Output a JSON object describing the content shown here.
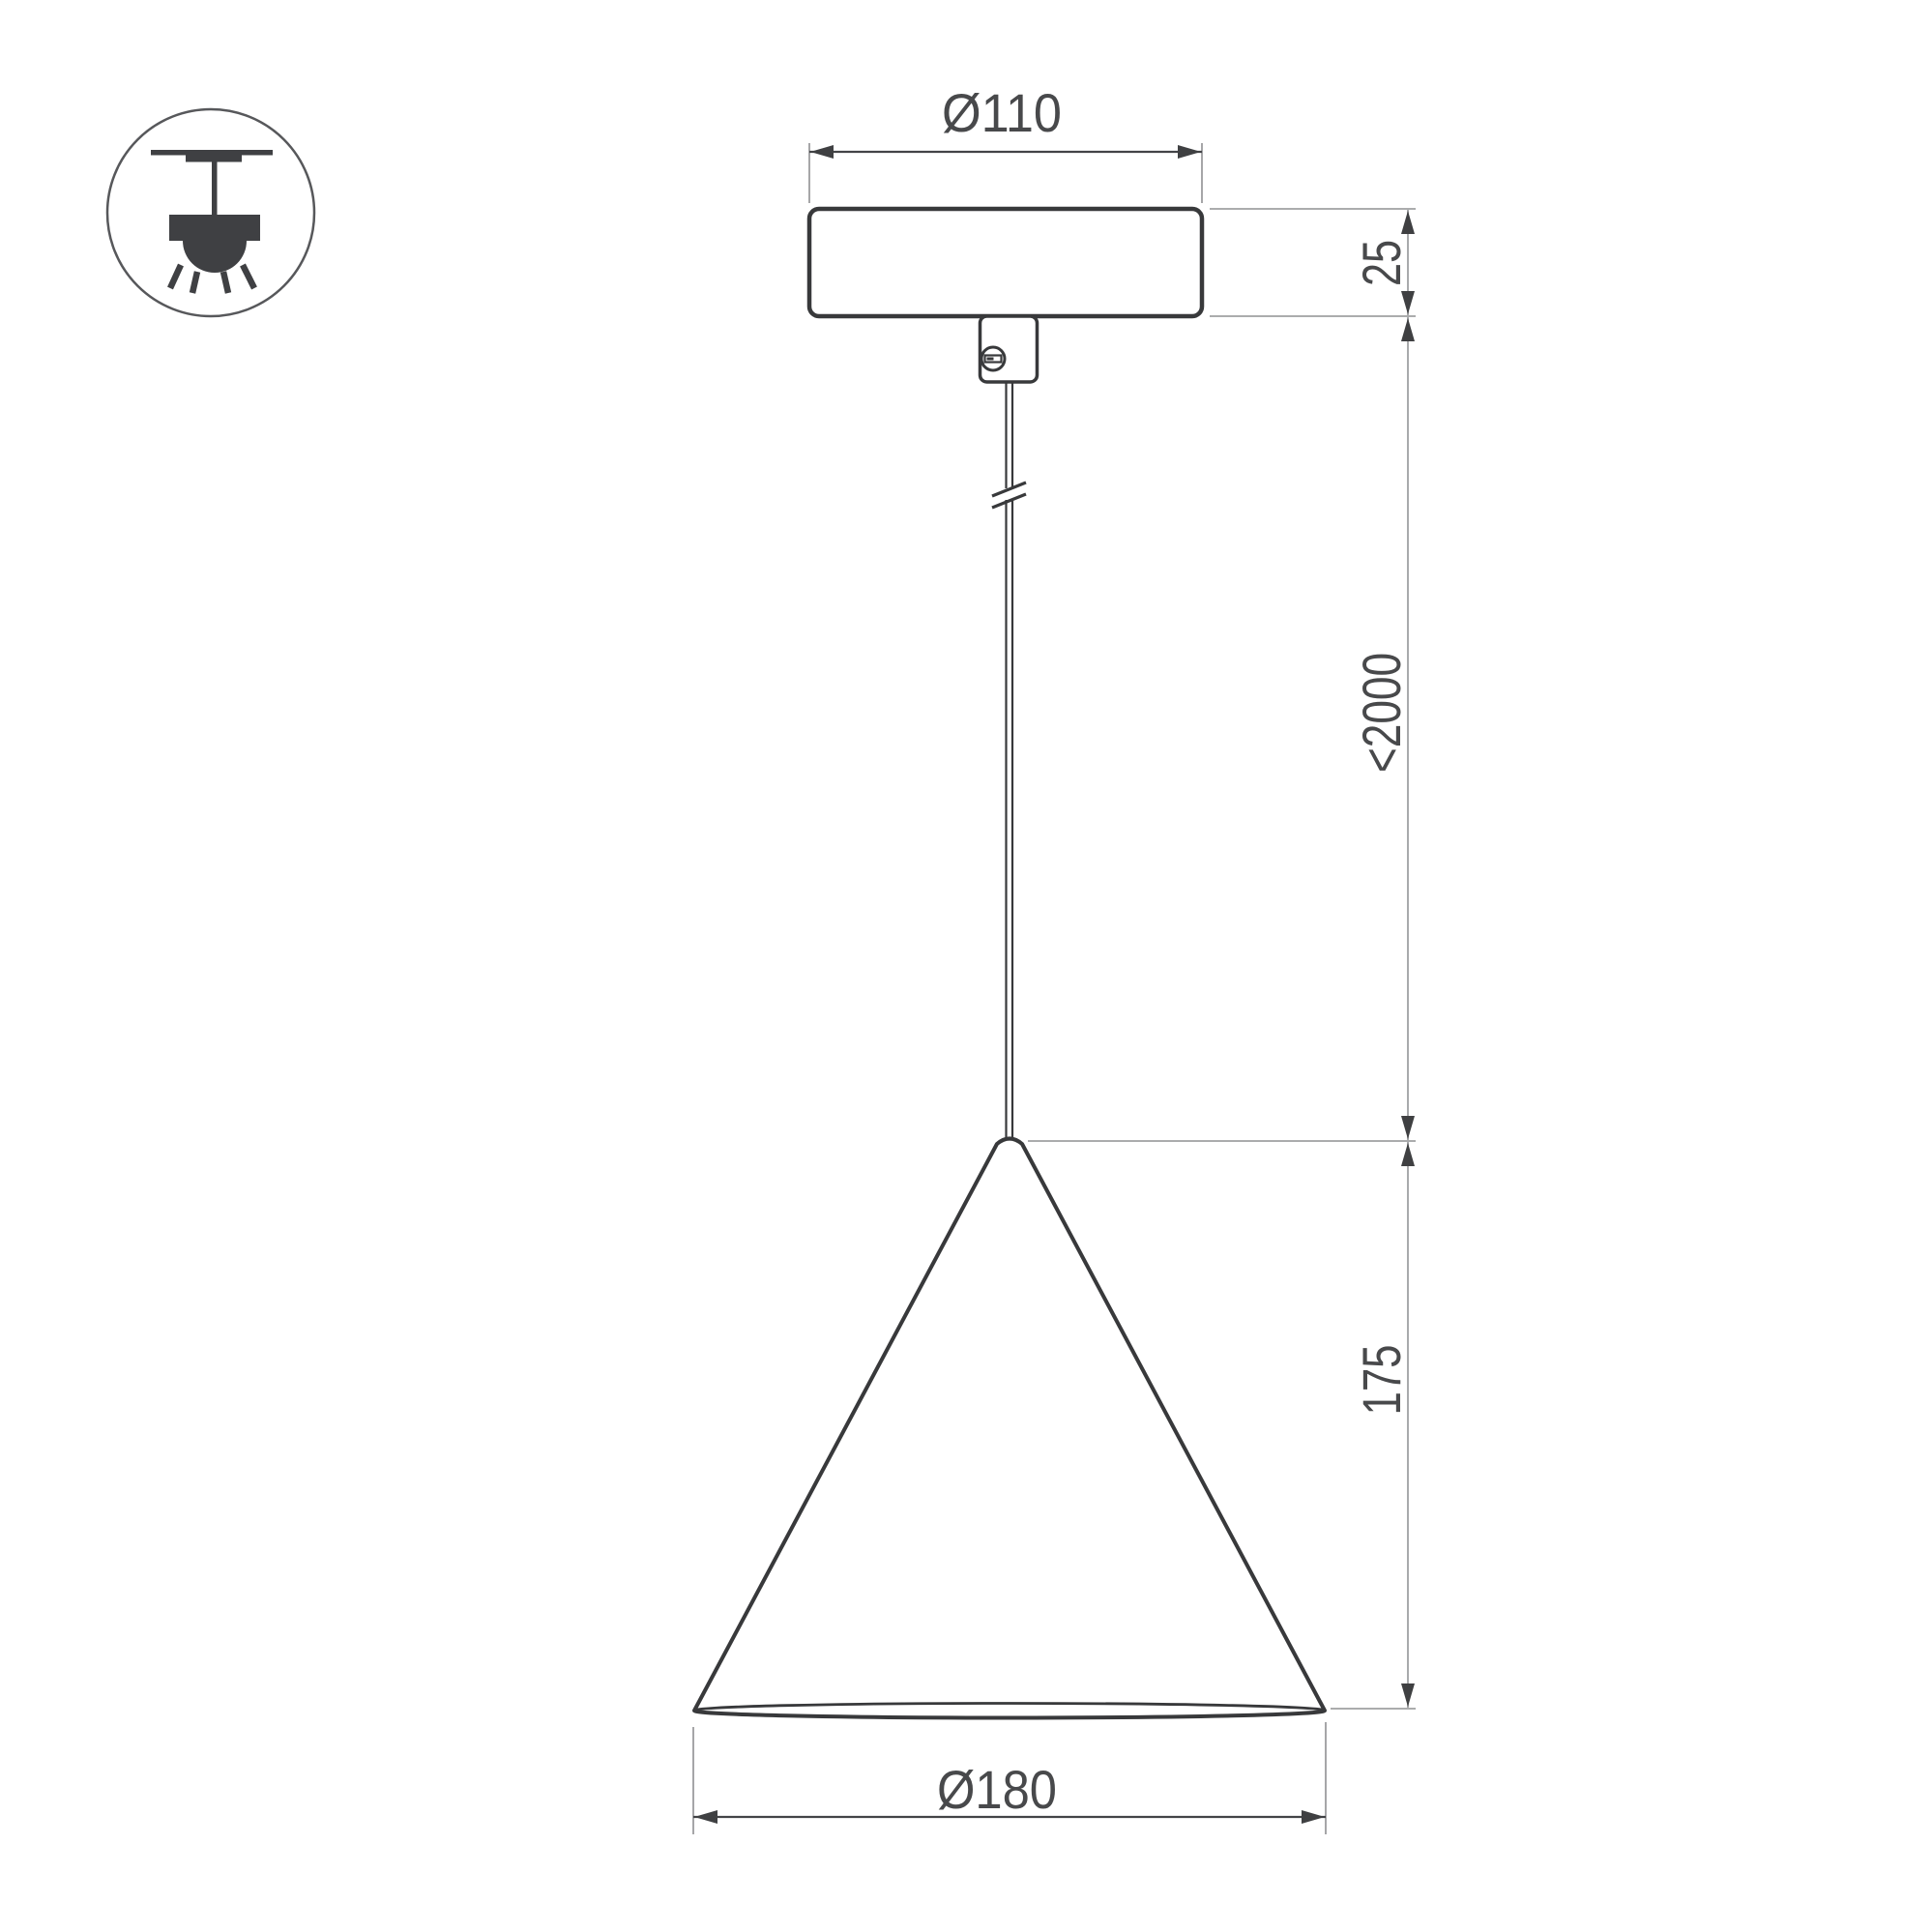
{
  "drawing": {
    "kind": "pendant-lamp-dimension-drawing",
    "icon": "ceiling-pendant-light-icon",
    "dimensions": {
      "canopy_diameter": "Ø110",
      "canopy_height": "25",
      "suspension_length": "<2000",
      "shade_height": "175",
      "shade_diameter": "Ø180"
    },
    "colors": {
      "outline": "#38393b",
      "dimension_line": "#434447",
      "extension_line": "#8f9092",
      "long_dimension_line": "#a9aaac",
      "arrow": "#3f4042",
      "label_text": "#48494b",
      "background": "#ffffff"
    }
  }
}
